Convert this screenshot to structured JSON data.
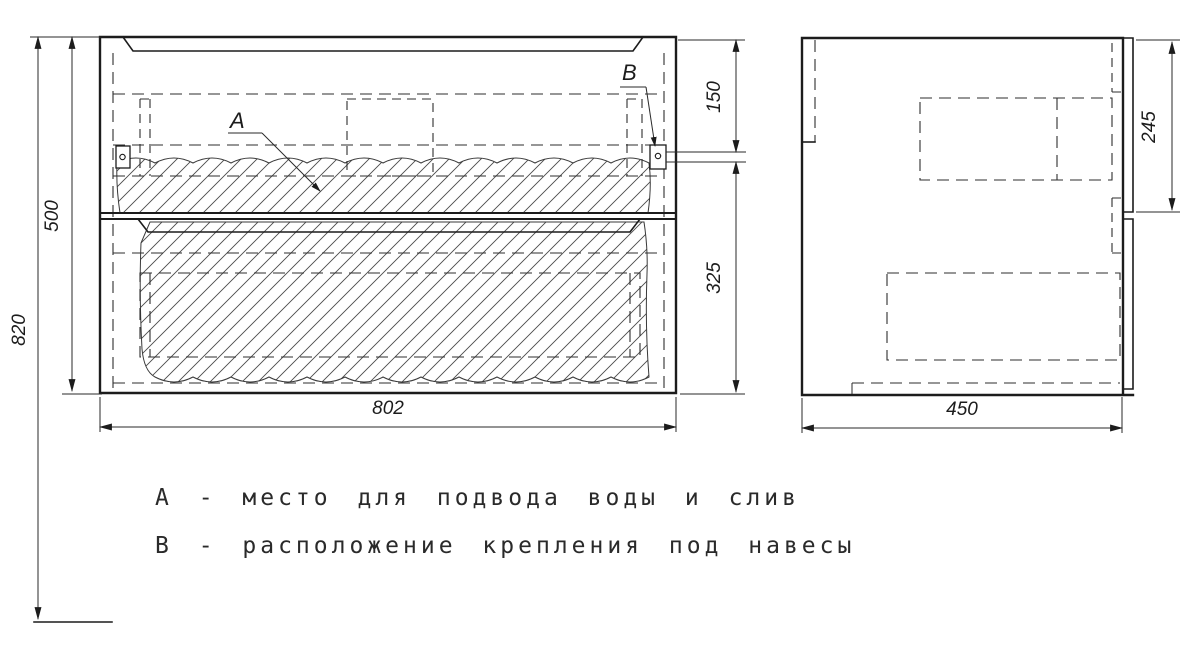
{
  "dimensions": {
    "total_height": "820",
    "body_height": "500",
    "body_width": "802",
    "hanger_top_offset": "150",
    "hanger_bottom_offset": "325",
    "hanger_rail_height": "245",
    "body_depth": "450"
  },
  "callouts": {
    "a": "A",
    "b": "B"
  },
  "notes": {
    "line_a": "А - место для подвода воды и слив",
    "line_b": "В - расположение крепления под навесы"
  },
  "colors": {
    "line": "#1c1c1c",
    "background": "#ffffff"
  }
}
